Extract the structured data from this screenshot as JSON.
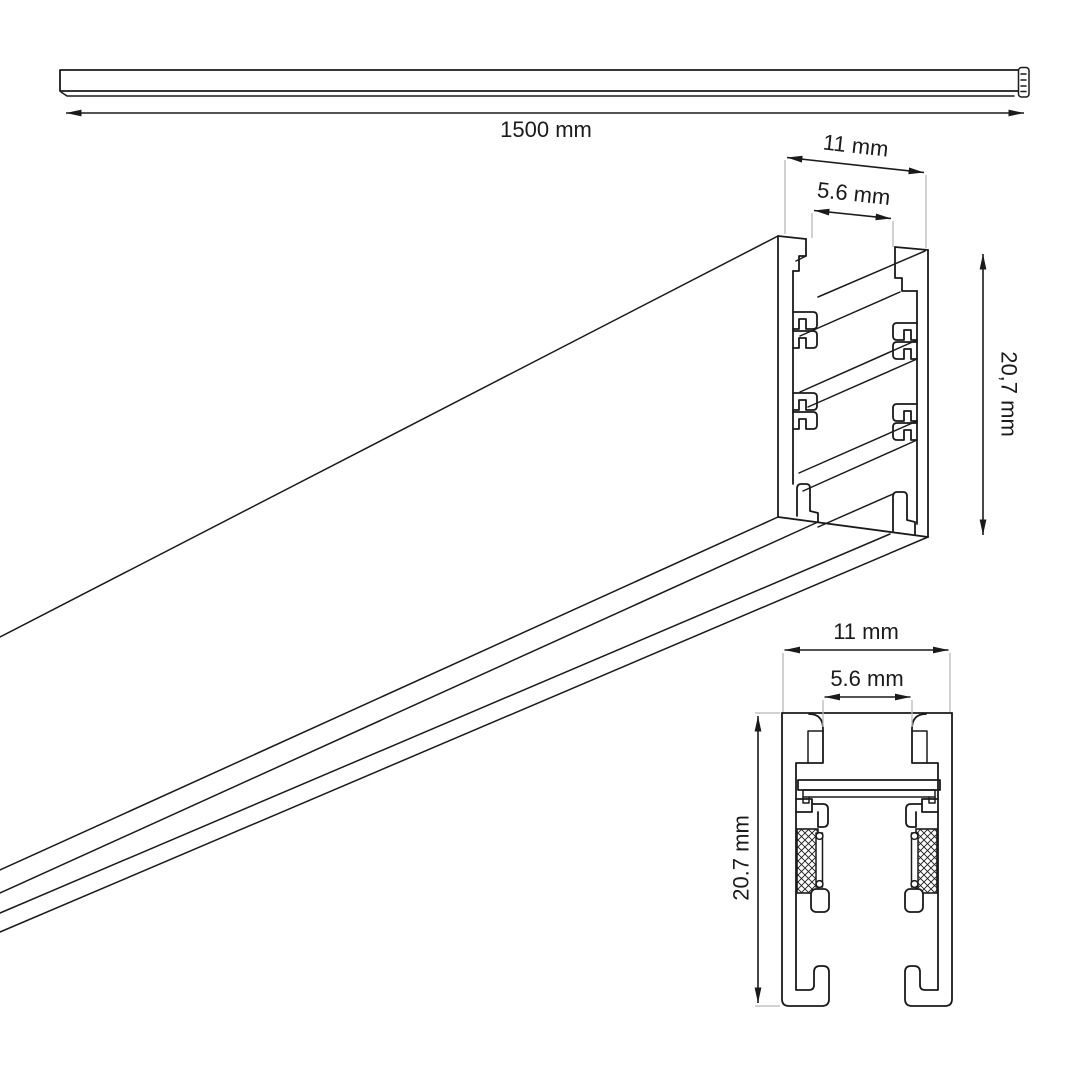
{
  "page": {
    "background": "#ffffff",
    "line_color": "#1a1a1a",
    "extension_line_color": "#b8b8b8"
  },
  "drawing": {
    "views": {
      "full_length": {
        "description": "rail shown over its full length",
        "dim_length": {
          "label": "1500 mm"
        }
      },
      "perspective": {
        "description": "perspective view of extruded rail profile end",
        "dim_width": {
          "label": "11 mm"
        },
        "dim_slot": {
          "label": "5.6 mm"
        },
        "dim_height": {
          "label": "20,7 mm"
        }
      },
      "cross_section": {
        "description": "2D cross section of rail profile with gasket inserts",
        "dim_width": {
          "label": "11 mm"
        },
        "dim_slot": {
          "label": "5.6 mm"
        },
        "dim_height": {
          "label": "20.7 mm"
        }
      }
    }
  }
}
